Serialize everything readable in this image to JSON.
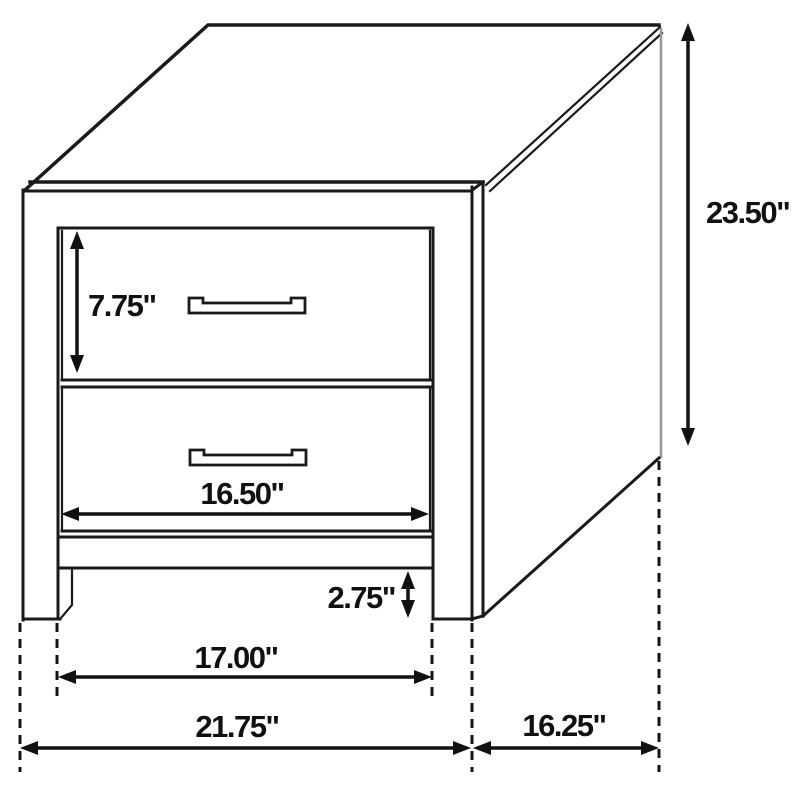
{
  "diagram": {
    "background": "#ffffff",
    "line_color": "#1a1a1a",
    "edge_highlight_color": "#979797",
    "dimensions": {
      "drawer_height": "7.75\"",
      "drawer_width": "16.50\"",
      "base_height": "2.75\"",
      "inner_width": "17.00\"",
      "overall_width": "21.75\"",
      "overall_height": "23.50\"",
      "depth": "16.25\""
    }
  }
}
